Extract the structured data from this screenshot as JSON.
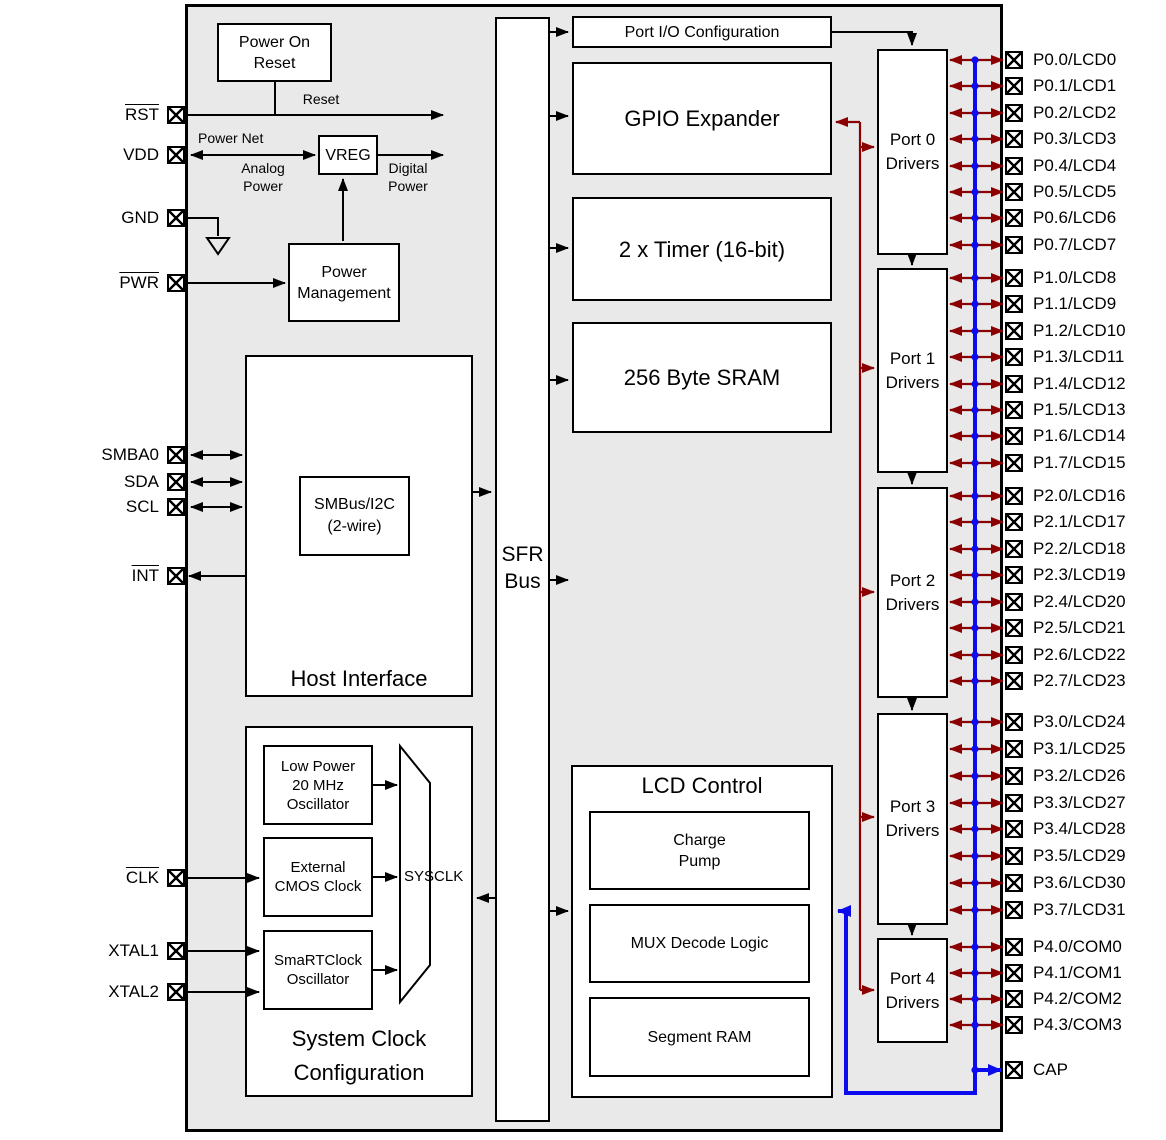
{
  "colors": {
    "chip_background": "#e9e9e9",
    "wire_black": "#000000",
    "gpio_bus_red": "#8b0000",
    "lcd_bus_blue": "#0b0bee"
  },
  "pins": {
    "left": [
      {
        "label": "RST",
        "overline": true
      },
      {
        "label": "VDD",
        "overline": false
      },
      {
        "label": "GND",
        "overline": false
      },
      {
        "label": "PWR",
        "overline": true
      },
      {
        "label": "SMBA0",
        "overline": false
      },
      {
        "label": "SDA",
        "overline": false
      },
      {
        "label": "SCL",
        "overline": false
      },
      {
        "label": "INT",
        "overline": true
      },
      {
        "label": "CLK",
        "overline": true
      },
      {
        "label": "XTAL1",
        "overline": false
      },
      {
        "label": "XTAL2",
        "overline": false
      }
    ],
    "right_groups": [
      {
        "driver": [
          "Port 0",
          "Drivers"
        ],
        "pins": [
          "P0.0/LCD0",
          "P0.1/LCD1",
          "P0.2/LCD2",
          "P0.3/LCD3",
          "P0.4/LCD4",
          "P0.5/LCD5",
          "P0.6/LCD6",
          "P0.7/LCD7"
        ]
      },
      {
        "driver": [
          "Port 1",
          "Drivers"
        ],
        "pins": [
          "P1.0/LCD8",
          "P1.1/LCD9",
          "P1.2/LCD10",
          "P1.3/LCD11",
          "P1.4/LCD12",
          "P1.5/LCD13",
          "P1.6/LCD14",
          "P1.7/LCD15"
        ]
      },
      {
        "driver": [
          "Port 2",
          "Drivers"
        ],
        "pins": [
          "P2.0/LCD16",
          "P2.1/LCD17",
          "P2.2/LCD18",
          "P2.3/LCD19",
          "P2.4/LCD20",
          "P2.5/LCD21",
          "P2.6/LCD22",
          "P2.7/LCD23"
        ]
      },
      {
        "driver": [
          "Port 3",
          "Drivers"
        ],
        "pins": [
          "P3.0/LCD24",
          "P3.1/LCD25",
          "P3.2/LCD26",
          "P3.3/LCD27",
          "P3.4/LCD28",
          "P3.5/LCD29",
          "P3.6/LCD30",
          "P3.7/LCD31"
        ]
      },
      {
        "driver": [
          "Port 4",
          "Drivers"
        ],
        "pins": [
          "P4.0/COM0",
          "P4.1/COM1",
          "P4.2/COM2",
          "P4.3/COM3"
        ]
      }
    ],
    "cap": "CAP"
  },
  "blocks": {
    "power_on_reset": [
      "Power On",
      "Reset"
    ],
    "vreg": "VREG",
    "power_management": [
      "Power",
      "Management"
    ],
    "host_interface": "Host Interface",
    "smbus": [
      "SMBus/I2C",
      "(2-wire)"
    ],
    "sfr_bus": [
      "SFR",
      "Bus"
    ],
    "port_io_config": "Port I/O Configuration",
    "gpio_expander": "GPIO Expander",
    "timer": "2 x Timer (16-bit)",
    "sram": "256 Byte SRAM",
    "lcd_control": "LCD Control",
    "charge_pump": [
      "Charge",
      "Pump"
    ],
    "mux_decode": "MUX Decode Logic",
    "segment_ram": "Segment RAM",
    "system_clock": [
      "System Clock",
      "Configuration"
    ],
    "low_power_osc": [
      "Low Power",
      "20 MHz",
      "Oscillator"
    ],
    "external_cmos": [
      "External",
      "CMOS Clock"
    ],
    "smartclock": [
      "SmaRTClock",
      "Oscillator"
    ],
    "sysclk": "SYSCLK"
  },
  "wire_labels": {
    "reset": "Reset",
    "power_net": "Power Net",
    "analog_power": [
      "Analog",
      "Power"
    ],
    "digital_power": [
      "Digital",
      "Power"
    ]
  }
}
